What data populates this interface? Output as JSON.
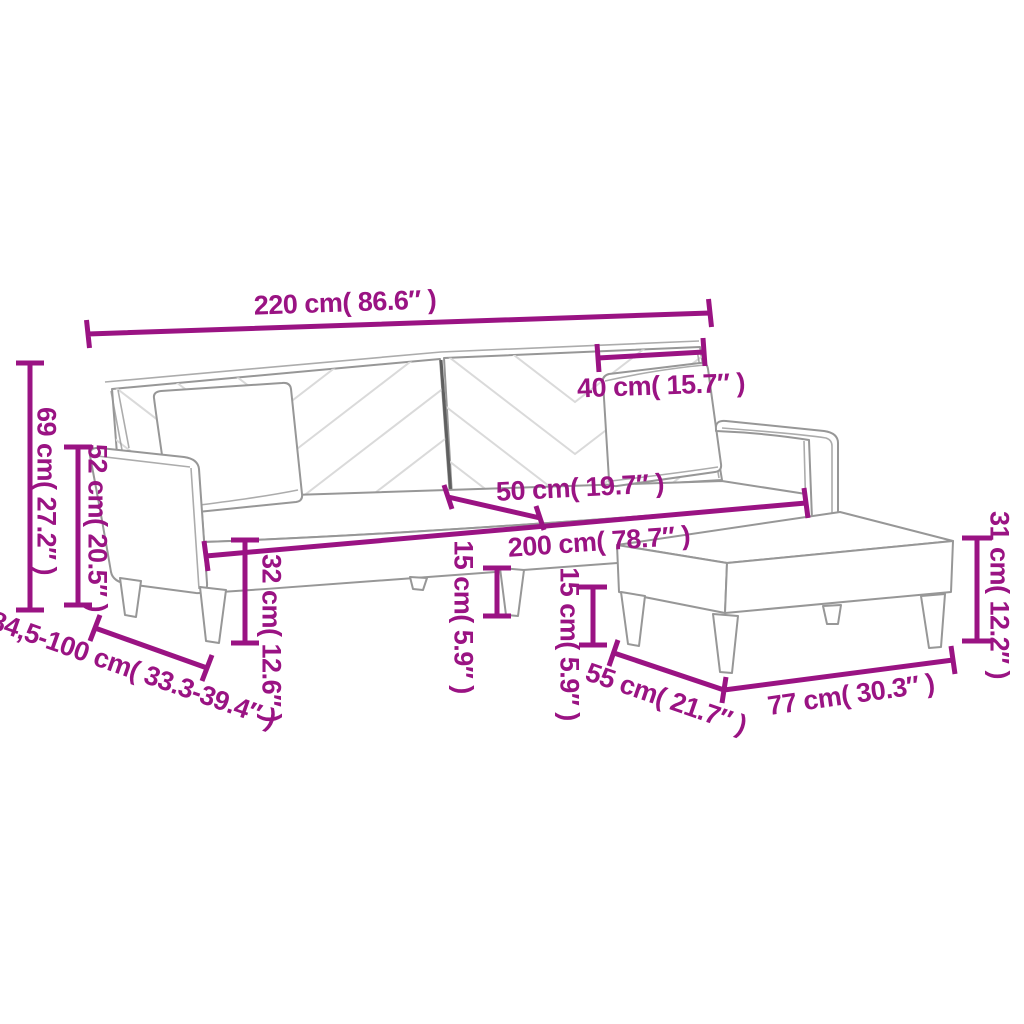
{
  "page": {
    "title": "Sofa bed with pillows and footstool - dimension diagram"
  },
  "style": {
    "accent_color": "#9a1383",
    "outline_color": "#979797",
    "chevron_color": "#dadada"
  },
  "diagram": {
    "subject": "two-seater sofa bed with two pillows and footstool, line drawing with dimension annotations",
    "measurements": {
      "sofa_width": {
        "label": "220 cm( 86.6″ )"
      },
      "cushion_width": {
        "label": "40 cm( 15.7″ )"
      },
      "total_height": {
        "label": "69 cm( 27.2″ )"
      },
      "armrest_height": {
        "label": "52 cm( 20.5″ )"
      },
      "seat_depth": {
        "label": "50 cm( 19.7″ )"
      },
      "seat_width": {
        "label": "200 cm( 78.7″ )"
      },
      "seat_height": {
        "label": "32 cm( 12.6″ )"
      },
      "sofa_leg_height": {
        "label": "15 cm( 5.9″ )"
      },
      "footstool_leg_height": {
        "label": "15 cm( 5.9″ )"
      },
      "sofa_depth_range": {
        "label": "84,5-100 cm( 33.3-39.4″ )"
      },
      "footstool_depth": {
        "label": "55 cm( 21.7″ )"
      },
      "footstool_width": {
        "label": "77 cm( 30.3″ )"
      },
      "footstool_height": {
        "label": "31 cm( 12.2″ )"
      }
    }
  }
}
